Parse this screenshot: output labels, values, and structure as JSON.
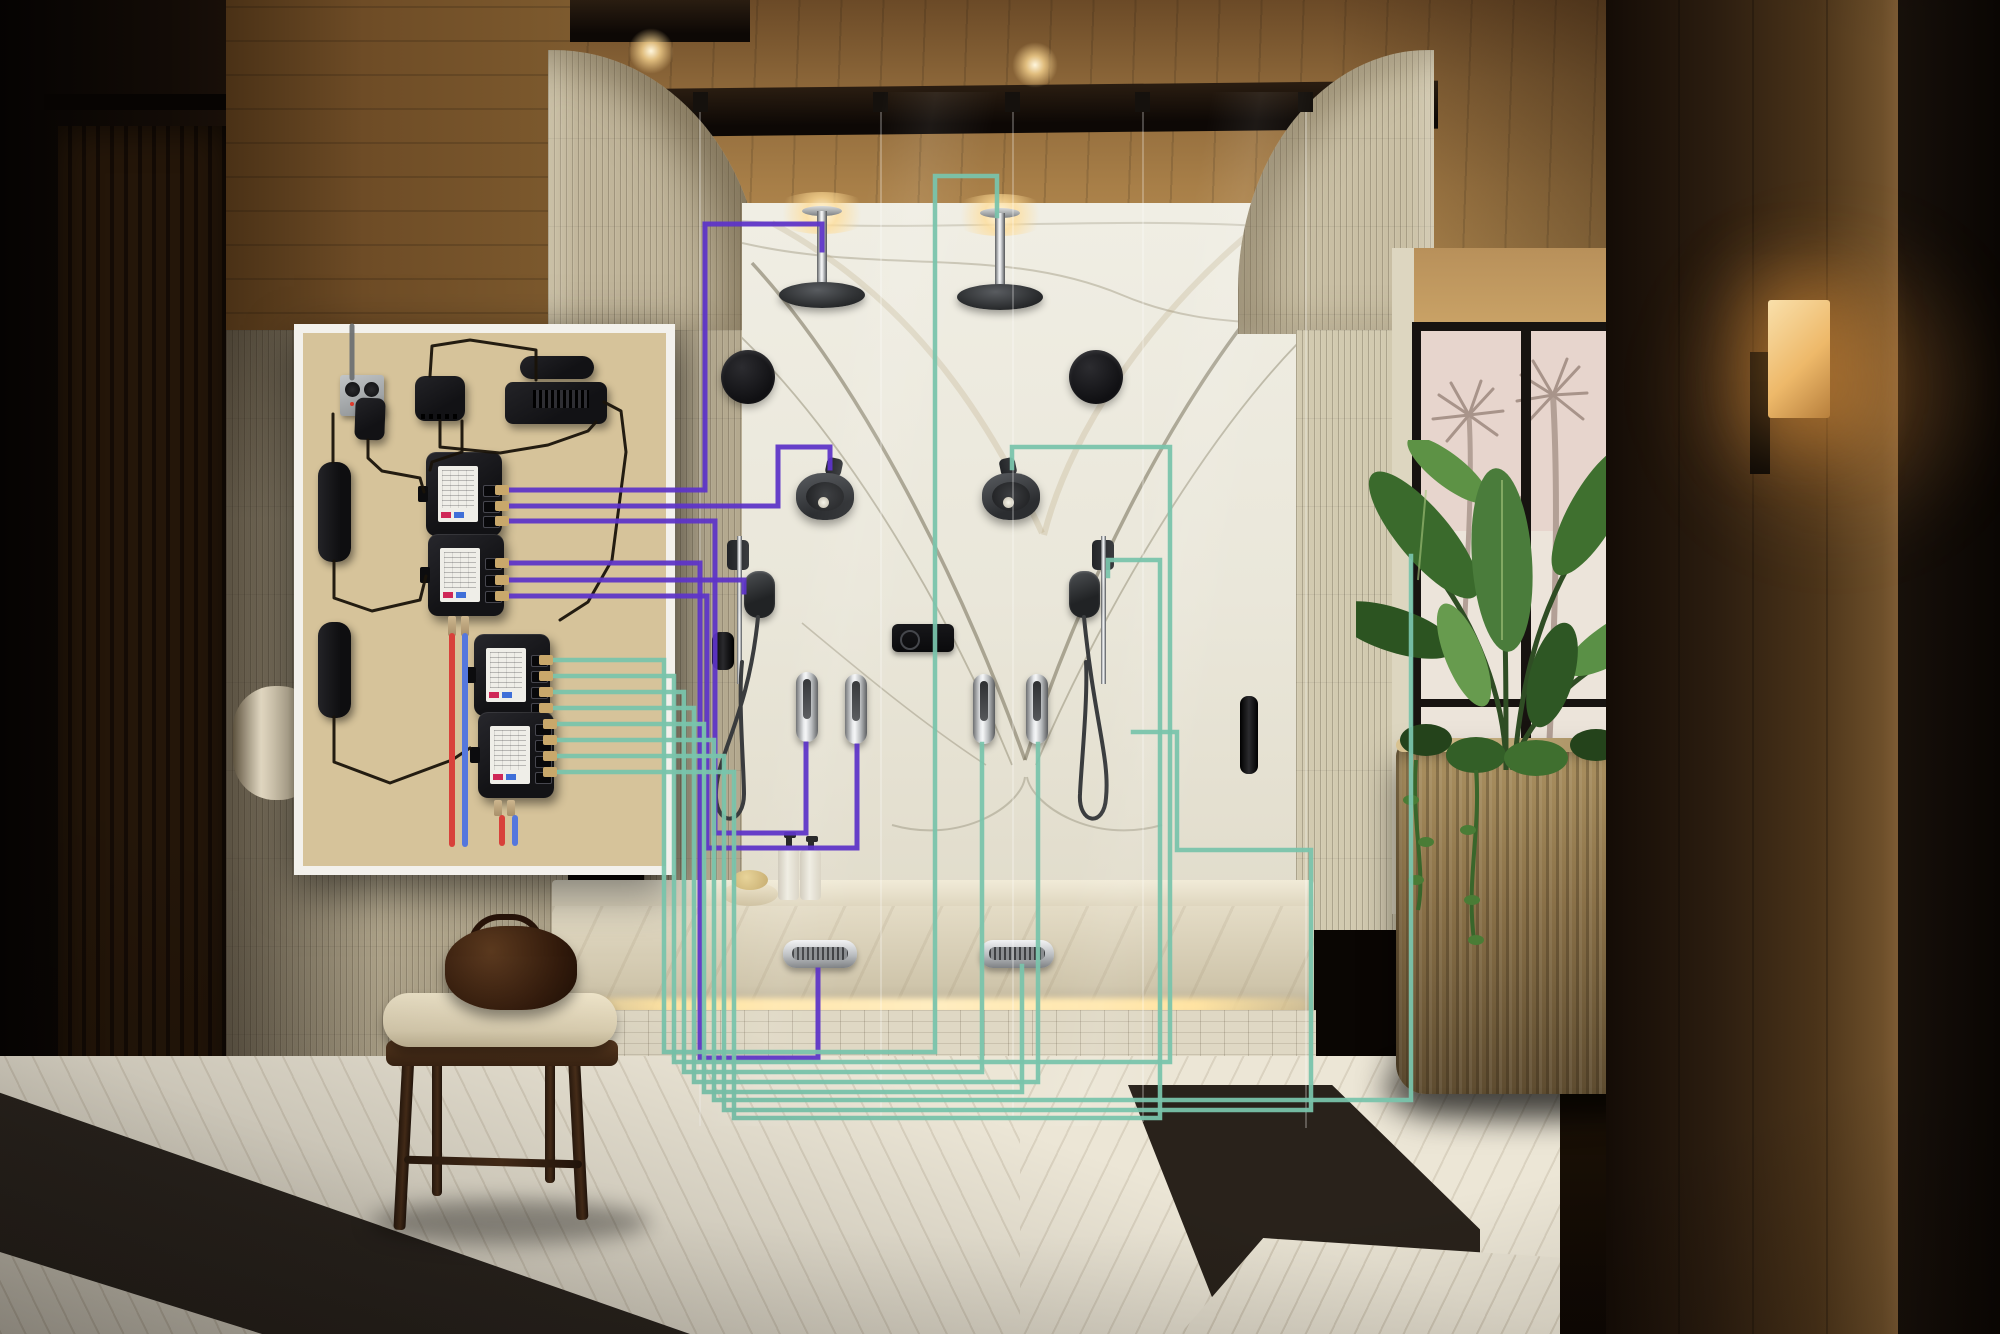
{
  "scene": {
    "type": "photographic product visualization",
    "subject": "luxury spa bathroom with double glass shower, book-matched marble wall, wood ceiling, palm-view window and plant",
    "overlay": "cutaway wall panel showing smart shower control hardware wired to each fixture"
  },
  "palette": {
    "wire_purple": "#5e34c8",
    "wire_teal": "#79c3ab",
    "pipe_hot_red": "#d8413a",
    "pipe_cold_blue": "#5577dd",
    "cable_black": "#191309",
    "conduit_gray": "#70747 6",
    "connector_brass": "#c9a86b",
    "panel_border_white": "#f3f1ec",
    "plywood": "#d6c39a",
    "module_black": "#1b1b1f",
    "marble_base": "#eceadf",
    "led_glow": "#ffe3a2"
  },
  "inset_panel": {
    "components": [
      {
        "name": "power-outlet-box"
      },
      {
        "name": "power-adapter"
      },
      {
        "name": "network-hub"
      },
      {
        "name": "interface-module"
      },
      {
        "name": "amplifier-module"
      },
      {
        "name": "power-brick-upper"
      },
      {
        "name": "power-brick-lower"
      },
      {
        "name": "valve-module-1",
        "wire_group": "purple",
        "ports": 3
      },
      {
        "name": "valve-module-2",
        "wire_group": "purple",
        "ports": 3
      },
      {
        "name": "valve-module-3",
        "wire_group": "teal",
        "ports": 4
      },
      {
        "name": "valve-module-4",
        "wire_group": "teal",
        "ports": 4
      }
    ]
  },
  "fixtures": [
    {
      "name": "rain-shower-left"
    },
    {
      "name": "rain-shower-right"
    },
    {
      "name": "speaker-left"
    },
    {
      "name": "speaker-right"
    },
    {
      "name": "shower-head-left"
    },
    {
      "name": "shower-head-right"
    },
    {
      "name": "slide-bar-left"
    },
    {
      "name": "slide-bar-right"
    },
    {
      "name": "handshower-left"
    },
    {
      "name": "handshower-right"
    },
    {
      "name": "digital-control-panel"
    },
    {
      "name": "spray-handle-left-1"
    },
    {
      "name": "spray-handle-left-2"
    },
    {
      "name": "spray-handle-right-1"
    },
    {
      "name": "spray-handle-right-2"
    },
    {
      "name": "steam-vent-left"
    },
    {
      "name": "steam-vent-right"
    }
  ],
  "diagram": {
    "wires": [
      {
        "id": "p1",
        "name": "wire-left-rainhead",
        "color": "purple",
        "width": 5,
        "points": [
          [
            505,
            490
          ],
          [
            705,
            490
          ],
          [
            705,
            224
          ],
          [
            822,
            224
          ],
          [
            822,
            250
          ]
        ]
      },
      {
        "id": "p2",
        "name": "wire-left-showerhead",
        "color": "purple",
        "width": 5,
        "points": [
          [
            505,
            506
          ],
          [
            778,
            506
          ],
          [
            778,
            447
          ],
          [
            830,
            447
          ],
          [
            830,
            468
          ]
        ]
      },
      {
        "id": "p3",
        "name": "wire-left-spray-handle-1",
        "color": "purple",
        "width": 5,
        "points": [
          [
            505,
            521
          ],
          [
            715,
            521
          ],
          [
            715,
            833
          ],
          [
            806,
            833
          ],
          [
            806,
            744
          ]
        ]
      },
      {
        "id": "p4",
        "name": "wire-left-steam-vent",
        "color": "purple",
        "width": 5,
        "points": [
          [
            505,
            563
          ],
          [
            700,
            563
          ],
          [
            700,
            1058
          ],
          [
            818,
            1058
          ],
          [
            818,
            970
          ]
        ]
      },
      {
        "id": "p5",
        "name": "wire-left-handshower",
        "color": "purple",
        "width": 5,
        "points": [
          [
            505,
            580
          ],
          [
            744,
            580
          ],
          [
            744,
            592
          ]
        ]
      },
      {
        "id": "p6",
        "name": "wire-left-spray-handle-2",
        "color": "purple",
        "width": 5,
        "points": [
          [
            505,
            596
          ],
          [
            707,
            596
          ],
          [
            707,
            848
          ],
          [
            857,
            848
          ],
          [
            857,
            746
          ]
        ]
      },
      {
        "id": "t1",
        "name": "wire-right-rainhead",
        "color": "teal",
        "width": 4.5,
        "points": [
          [
            549,
            660
          ],
          [
            664,
            660
          ],
          [
            664,
            1052
          ],
          [
            935,
            1052
          ],
          [
            935,
            176
          ],
          [
            997,
            176
          ],
          [
            997,
            216
          ]
        ]
      },
      {
        "id": "t2",
        "name": "wire-right-showerhead",
        "color": "teal",
        "width": 4.5,
        "points": [
          [
            549,
            676
          ],
          [
            674,
            676
          ],
          [
            674,
            1062
          ],
          [
            1170,
            1062
          ],
          [
            1170,
            447
          ],
          [
            1012,
            447
          ],
          [
            1012,
            468
          ]
        ]
      },
      {
        "id": "t3",
        "name": "wire-right-spray-handle-1",
        "color": "teal",
        "width": 4.5,
        "points": [
          [
            549,
            692
          ],
          [
            684,
            692
          ],
          [
            684,
            1072
          ],
          [
            982,
            1072
          ],
          [
            982,
            744
          ]
        ]
      },
      {
        "id": "t4",
        "name": "wire-right-spray-handle-2",
        "color": "teal",
        "width": 4.5,
        "points": [
          [
            549,
            708
          ],
          [
            694,
            708
          ],
          [
            694,
            1082
          ],
          [
            1038,
            1082
          ],
          [
            1038,
            744
          ]
        ]
      },
      {
        "id": "t5",
        "name": "wire-right-steam-vent",
        "color": "teal",
        "width": 4.5,
        "points": [
          [
            553,
            724
          ],
          [
            704,
            724
          ],
          [
            704,
            1092
          ],
          [
            1022,
            1092
          ],
          [
            1022,
            966
          ]
        ]
      },
      {
        "id": "t6",
        "name": "wire-right-wall-run",
        "color": "teal",
        "width": 4.5,
        "points": [
          [
            553,
            740
          ],
          [
            714,
            740
          ],
          [
            714,
            1100
          ],
          [
            1411,
            1100
          ],
          [
            1411,
            556
          ]
        ]
      },
      {
        "id": "t7",
        "name": "wire-right-return-loop",
        "color": "teal",
        "width": 4.5,
        "points": [
          [
            553,
            756
          ],
          [
            724,
            756
          ],
          [
            724,
            1110
          ],
          [
            1311,
            1110
          ],
          [
            1311,
            850
          ],
          [
            1177,
            850
          ],
          [
            1177,
            732
          ],
          [
            1133,
            732
          ]
        ]
      },
      {
        "id": "t8",
        "name": "wire-right-handshower",
        "color": "teal",
        "width": 4.5,
        "points": [
          [
            553,
            772
          ],
          [
            734,
            772
          ],
          [
            734,
            1118
          ],
          [
            1160,
            1118
          ],
          [
            1160,
            560
          ],
          [
            1108,
            560
          ],
          [
            1108,
            576
          ]
        ]
      }
    ],
    "pipes": [
      {
        "id": "hot1",
        "name": "hot-water-pipe-upper",
        "color": "#d8413a",
        "width": 6,
        "points": [
          [
            452,
            636
          ],
          [
            452,
            844
          ]
        ]
      },
      {
        "id": "cold1",
        "name": "cold-water-pipe-upper",
        "color": "#5577dd",
        "width": 6,
        "points": [
          [
            465,
            636
          ],
          [
            465,
            844
          ]
        ]
      },
      {
        "id": "hot2",
        "name": "hot-water-pipe-lower",
        "color": "#d8413a",
        "width": 6,
        "points": [
          [
            502,
            818
          ],
          [
            502,
            843
          ]
        ]
      },
      {
        "id": "cold2",
        "name": "cold-water-pipe-lower",
        "color": "#5577dd",
        "width": 6,
        "points": [
          [
            515,
            818
          ],
          [
            515,
            843
          ]
        ]
      }
    ],
    "cables": [
      {
        "id": "c0",
        "name": "conduit-to-outlet",
        "color": "#6e7173",
        "width": 5,
        "points": [
          [
            352,
            326
          ],
          [
            352,
            378
          ]
        ]
      },
      {
        "id": "c1",
        "name": "outlet-to-brick",
        "color": "#191309",
        "width": 3,
        "points": [
          [
            333,
            414
          ],
          [
            333,
            462
          ]
        ]
      },
      {
        "id": "c2",
        "name": "adapter-cable",
        "color": "#191309",
        "width": 3,
        "points": [
          [
            368,
            440
          ],
          [
            368,
            458
          ],
          [
            382,
            471
          ],
          [
            420,
            478
          ],
          [
            424,
            492
          ]
        ]
      },
      {
        "id": "c3",
        "name": "brick1-to-module2",
        "color": "#191309",
        "width": 3,
        "points": [
          [
            334,
            561
          ],
          [
            334,
            598
          ],
          [
            372,
            611
          ],
          [
            420,
            600
          ],
          [
            426,
            576
          ]
        ]
      },
      {
        "id": "c4",
        "name": "brick2-to-module3",
        "color": "#191309",
        "width": 3,
        "points": [
          [
            334,
            717
          ],
          [
            334,
            762
          ],
          [
            390,
            783
          ],
          [
            452,
            760
          ],
          [
            470,
            748
          ]
        ]
      },
      {
        "id": "c5",
        "name": "hub-loop-cable",
        "color": "#191309",
        "width": 3,
        "points": [
          [
            440,
            421
          ],
          [
            440,
            447
          ],
          [
            500,
            453
          ],
          [
            548,
            445
          ],
          [
            588,
            431
          ],
          [
            596,
            422
          ]
        ]
      },
      {
        "id": "c6",
        "name": "hub-to-module1",
        "color": "#191309",
        "width": 3,
        "points": [
          [
            462,
            421
          ],
          [
            462,
            452
          ],
          [
            432,
            462
          ],
          [
            430,
            470
          ]
        ]
      },
      {
        "id": "c7",
        "name": "device-top-arc",
        "color": "#191309",
        "width": 3,
        "points": [
          [
            536,
            380
          ],
          [
            536,
            350
          ],
          [
            470,
            340
          ],
          [
            432,
            346
          ],
          [
            430,
            376
          ]
        ]
      },
      {
        "id": "c8",
        "name": "device-down-cable",
        "color": "#191309",
        "width": 3,
        "points": [
          [
            604,
            402
          ],
          [
            621,
            411
          ],
          [
            626,
            452
          ],
          [
            612,
            560
          ],
          [
            588,
            602
          ],
          [
            560,
            620
          ]
        ]
      }
    ]
  }
}
